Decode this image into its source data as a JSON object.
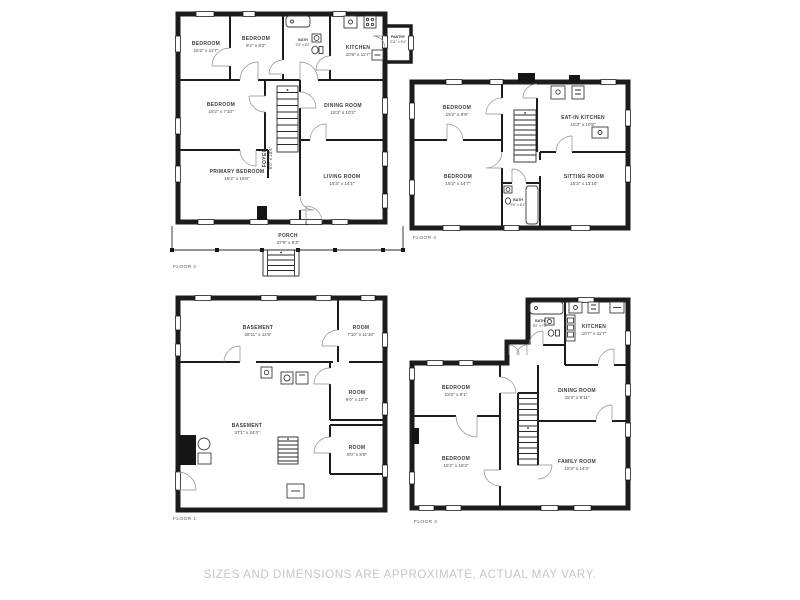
{
  "page": {
    "background": "#ffffff"
  },
  "colors": {
    "wall": "#1c1c1c",
    "room_label_text": "#3d3d3d",
    "dimension_text": "#4a4a4a",
    "floor_label_text": "#5a5a5a",
    "disclaimer_text": "#c6c6c6",
    "background": "#ffffff"
  },
  "footer": {
    "disclaimer": "SIZES AND DIMENSIONS ARE APPROXIMATE, ACTUAL MAY VARY."
  },
  "floors": [
    {
      "id": "floor-2",
      "label": "FLOOR 2",
      "rooms": [
        {
          "name": "BEDROOM",
          "dims": "15'2\" x 11'7\""
        },
        {
          "name": "BEDROOM",
          "dims": "9'2\" x 8'2\""
        },
        {
          "name": "BATH",
          "dims": "5'3\" x 8'2\""
        },
        {
          "name": "KITCHEN",
          "dims": "10'9\" x 11'7\""
        },
        {
          "name": "PANTRY",
          "dims": "3'11\" x 5'4\""
        },
        {
          "name": "BEDROOM",
          "dims": "15'2\" x 7'10\""
        },
        {
          "name": "DINING ROOM",
          "dims": "15'3\" x 10'3\""
        },
        {
          "name": "PRIMARY BEDROOM",
          "dims": "15'2\" x 16'6\""
        },
        {
          "name": "FOYER",
          "dims": "6'0\" x 18'4\""
        },
        {
          "name": "LIVING ROOM",
          "dims": "15'3\" x 14'1\""
        },
        {
          "name": "PORCH",
          "dims": "37'9\" x 5'3\""
        }
      ]
    },
    {
      "id": "floor-4",
      "label": "FLOOR 4",
      "rooms": [
        {
          "name": "BEDROOM",
          "dims": "15'2\" x 9'9\""
        },
        {
          "name": "EAT-IN KITCHEN",
          "dims": "15'3\" x 10'8\""
        },
        {
          "name": "BEDROOM",
          "dims": "15'2\" x 14'7\""
        },
        {
          "name": "BATH",
          "dims": "5'0\" x 6'1\""
        },
        {
          "name": "SITTING ROOM",
          "dims": "15'3\" x 13'10\""
        }
      ]
    },
    {
      "id": "floor-1",
      "label": "FLOOR 1",
      "rooms": [
        {
          "name": "BASEMENT",
          "dims": "28'11\" x 11'9\""
        },
        {
          "name": "ROOM",
          "dims": "7'10\" x 11'10\""
        },
        {
          "name": "ROOM",
          "dims": "9'0\" x 10'7\""
        },
        {
          "name": "BASEMENT",
          "dims": "37'1\" x 24'4\""
        },
        {
          "name": "ROOM",
          "dims": "9'0\" x 8'9\""
        }
      ]
    },
    {
      "id": "floor-3",
      "label": "FLOOR 3",
      "rooms": [
        {
          "name": "BATH",
          "dims": "5'0\" x 7'8\""
        },
        {
          "name": "KITCHEN",
          "dims": "10'7\" x 11'7\""
        },
        {
          "name": "BEDROOM",
          "dims": "15'2\" x 9'1\""
        },
        {
          "name": "DINING ROOM",
          "dims": "15'3\" x 9'11\""
        },
        {
          "name": "BEDROOM",
          "dims": "15'2\" x 15'3\""
        },
        {
          "name": "FAMILY ROOM",
          "dims": "15'3\" x 14'3\""
        }
      ]
    }
  ]
}
